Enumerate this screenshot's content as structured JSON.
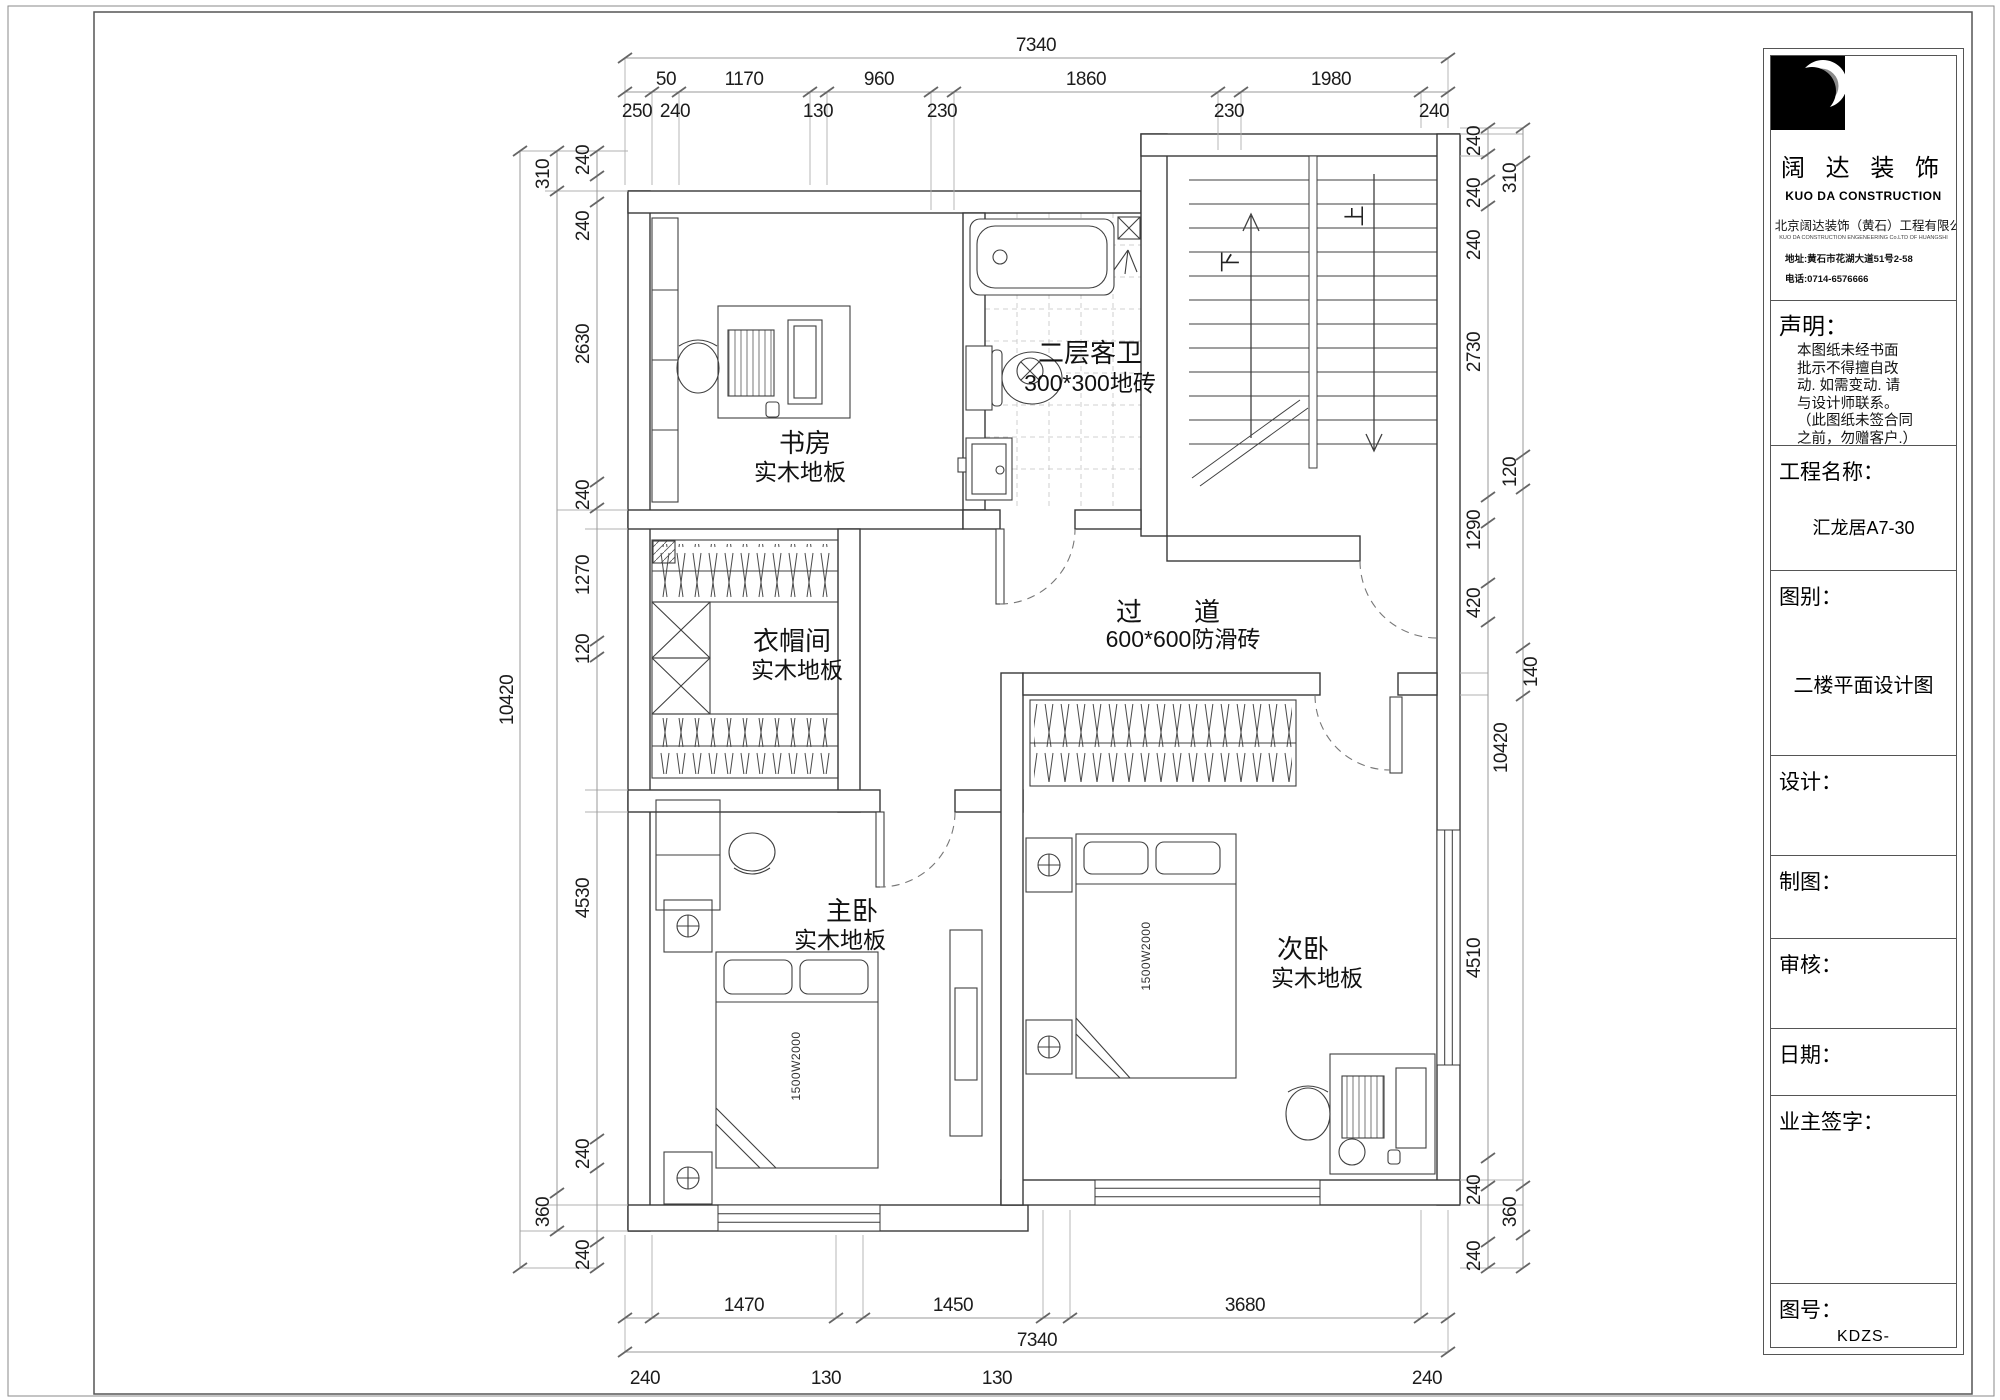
{
  "title_block": {
    "brand_cn": "阔 达 装 饰",
    "brand_en": "KUO DA CONSTRUCTION",
    "company_cn": "北京阔达装饰（黄石）工程有限公司",
    "company_en": "KUO DA CONSTRUCTION ENGENEERING Co.LTD OF HUANGSHI",
    "address": "地址:黄石市花湖大道51号2-58",
    "phone": "电话:0714-6576666",
    "statement_label": "声明：",
    "statement_lines": [
      "本图纸未经书面",
      "批示不得擅自改",
      "动. 如需变动. 请",
      "与设计师联系。",
      "（此图纸未签合同",
      "之前，勿赠客户.）"
    ],
    "project_label": "工程名称：",
    "project_value": "汇龙居A7-30",
    "sheet_type_label": "图别：",
    "sheet_type_value": "二楼平面设计图",
    "designer_label": "设计：",
    "drafter_label": "制图：",
    "checker_label": "审核：",
    "date_label": "日期：",
    "owner_label": "业主签字：",
    "number_label": "图号：",
    "number_value": "KDZS-"
  },
  "plan": {
    "rooms": {
      "study": {
        "name": "书房",
        "floor": "实木地板"
      },
      "bath": {
        "name": "二层客卫",
        "floor": "300*300地砖"
      },
      "cloak": {
        "name": "衣帽间",
        "floor": "实木地板"
      },
      "hall": {
        "name": "过　　道",
        "floor": "600*600防滑砖"
      },
      "master": {
        "name": "主卧",
        "floor": "实木地板"
      },
      "second": {
        "name": "次卧",
        "floor": "实木地板"
      }
    },
    "stair_down": "下",
    "stair_up": "上",
    "bed_size": "1500W2000"
  },
  "dims": {
    "top": {
      "overall": "7340",
      "segs": [
        "50",
        "1170",
        "960",
        "1860",
        "1980"
      ],
      "walls": [
        "250",
        "240",
        "130",
        "230",
        "230",
        "240"
      ]
    },
    "bottom": {
      "segs": [
        "1470",
        "1450",
        "3680"
      ],
      "overall": "7340",
      "walls": [
        "240",
        "130",
        "130",
        "240"
      ]
    },
    "left": {
      "overall": "10420",
      "chain": [
        "240",
        "240",
        "2630",
        "240",
        "1270",
        "120",
        "4530",
        "240",
        "240"
      ],
      "outer": [
        "310",
        "360"
      ]
    },
    "right": {
      "overall": "10420",
      "chain": [
        "240",
        "240",
        "240",
        "2730",
        "1290",
        "420",
        "4510",
        "240",
        "240"
      ],
      "outer": [
        "310",
        "120",
        "140",
        "360"
      ]
    }
  }
}
